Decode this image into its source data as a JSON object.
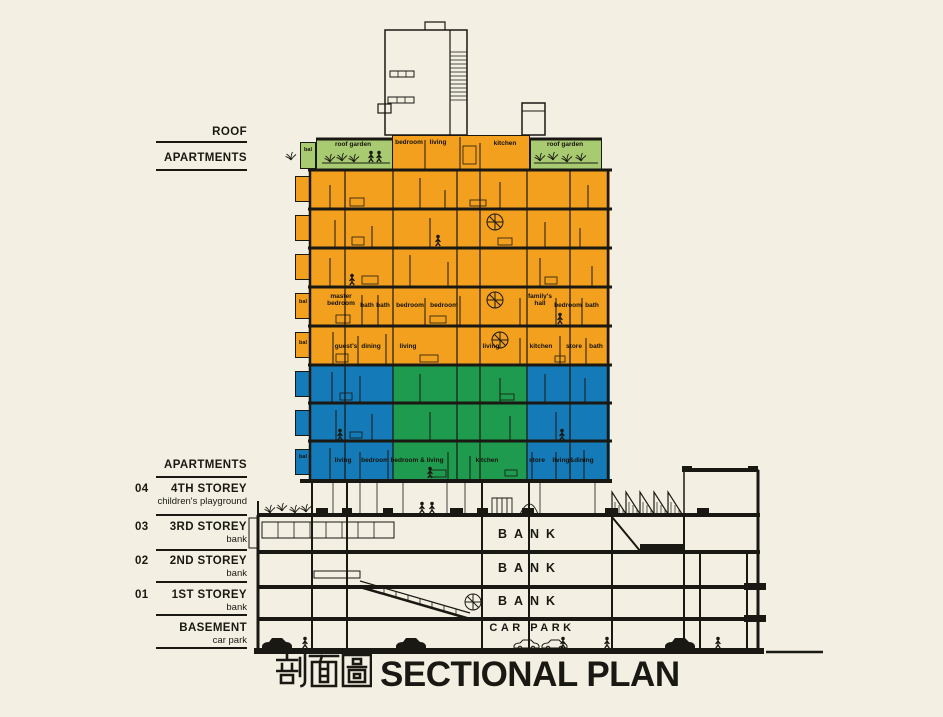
{
  "title": {
    "zh": "剖面圖",
    "en": "SECTIONAL PLAN"
  },
  "colors": {
    "paper": "#f3f0e3",
    "ink": "#1a1812",
    "orange": "#f2a01e",
    "blue": "#157ab8",
    "green": "#1e9b4e",
    "roof_green": "#a8cb72"
  },
  "left_labels": [
    {
      "num": "",
      "title": "ROOF",
      "sub": ""
    },
    {
      "num": "",
      "title": "APARTMENTS",
      "sub": ""
    },
    {
      "num": "",
      "title": "APARTMENTS",
      "sub": ""
    },
    {
      "num": "04",
      "title": "4TH STOREY",
      "sub": "children's playground"
    },
    {
      "num": "03",
      "title": "3RD STOREY",
      "sub": "bank"
    },
    {
      "num": "02",
      "title": "2ND STOREY",
      "sub": "bank"
    },
    {
      "num": "01",
      "title": "1ST STOREY",
      "sub": "bank"
    },
    {
      "num": "",
      "title": "BASEMENT",
      "sub": "car park"
    }
  ],
  "rooms": {
    "bal": "bal",
    "roof": [
      "roof garden",
      "bedroom",
      "living",
      "kitchen",
      "roof garden"
    ],
    "floor_bed": [
      "master bedroom",
      "bath",
      "bath",
      "bedroom",
      "bedroom",
      "family's hall",
      "bedroom",
      "bath"
    ],
    "floor_living": [
      "guest's",
      "dining",
      "living",
      "living",
      "kitchen",
      "store",
      "bath"
    ],
    "floor_lower": [
      "living",
      "bedroom",
      "bedroom & living",
      "kitchen",
      "store",
      "living&dining"
    ]
  },
  "podium": {
    "bank_labels": [
      "BANK",
      "BANK",
      "BANK"
    ],
    "car_park": "CAR PARK"
  }
}
